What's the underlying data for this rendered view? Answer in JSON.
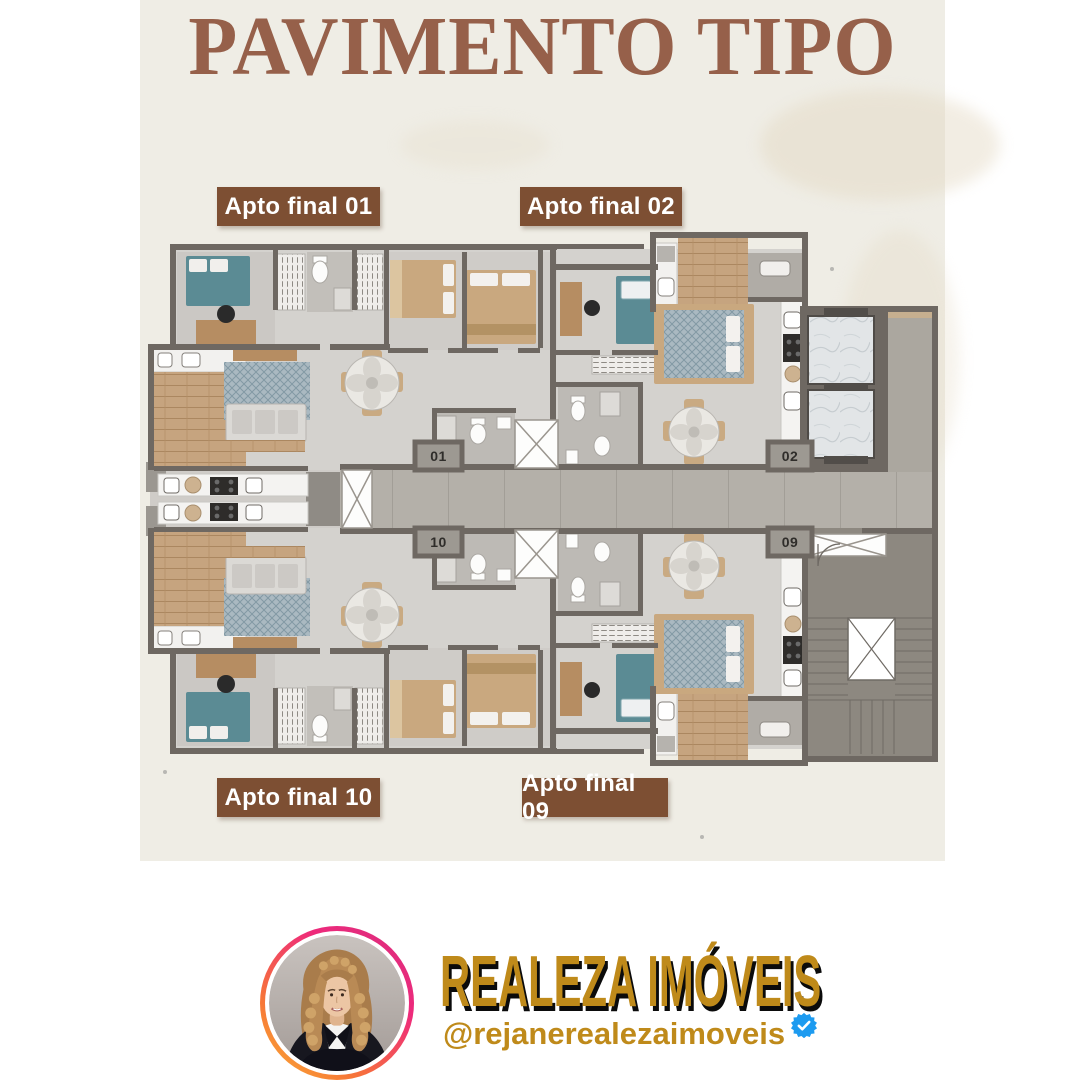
{
  "title": "PAVIMENTO TIPO",
  "colors": {
    "title": "#96604a",
    "label_bg": "#7d4f33",
    "panel_bg": "#efede5",
    "brand_gold": "#bf8a1a",
    "verified_blue": "#1d9bf0",
    "plan_wall": "#6e6862",
    "plan_floor": "#d4d2ce",
    "plan_corridor": "#b4b0a9"
  },
  "apartment_labels": [
    {
      "id": "apto-final-01",
      "label": "Apto final 01"
    },
    {
      "id": "apto-final-02",
      "label": "Apto final 02"
    },
    {
      "id": "apto-final-10",
      "label": "Apto final 10"
    },
    {
      "id": "apto-final-09",
      "label": "Apto final 09"
    }
  ],
  "floor_plan": {
    "unit_numbers": {
      "top_left": "01",
      "top_right": "02",
      "bottom_left": "10",
      "bottom_right": "09"
    }
  },
  "footer": {
    "brand": "REALEZA IMÓVEIS",
    "handle": "@rejanerealezaimoveis"
  }
}
